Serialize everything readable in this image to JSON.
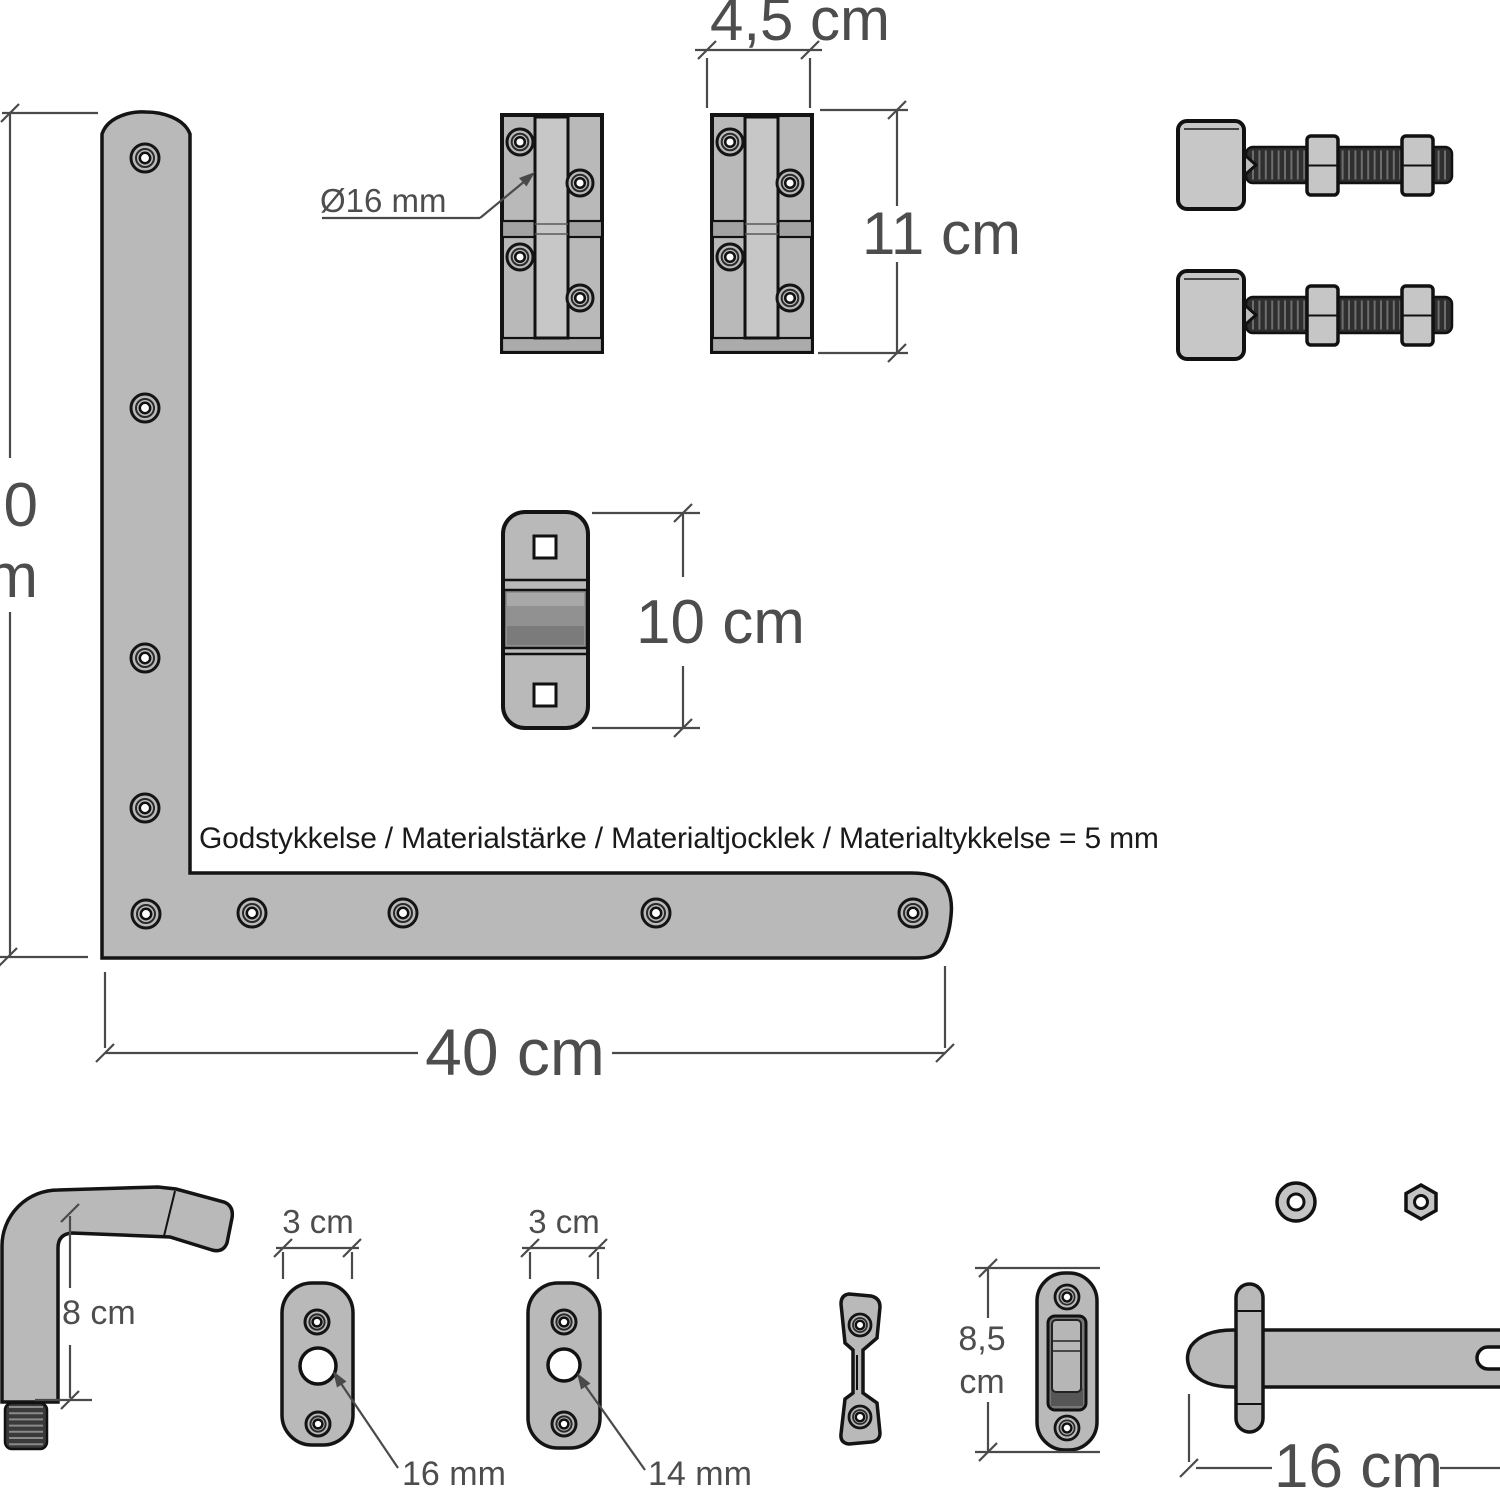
{
  "labels": {
    "hinge_block_width": "4,5 cm",
    "hinge_block_height": "11 cm",
    "pin_diameter": "Ø16 mm",
    "roller_keeper_height": "10 cm",
    "bracket_height_cut_line1": "0",
    "bracket_height_cut_line2": "m",
    "material_note": "Godstykkelse / Materialstärke / Materialtjocklek / Materialtykkelse = 5 mm",
    "bracket_width": "40 cm",
    "hook_height": "8 cm",
    "plate_16_width": "3 cm",
    "plate_14_width": "3 cm",
    "plate_16_hole": "16 mm",
    "plate_14_hole": "14 mm",
    "latch_keeper_height_value": "8,5",
    "latch_keeper_height_unit": "cm",
    "drop_bolt_length": "16 cm"
  },
  "colors": {
    "background": "#ffffff",
    "part_fill": "#b9b9b9",
    "part_outline": "#141414",
    "dark_metal": "#2f2f2f",
    "dim_line": "#4a4a4a",
    "dim_text": "#4d4d4d",
    "note_text": "#1a1a1a"
  }
}
